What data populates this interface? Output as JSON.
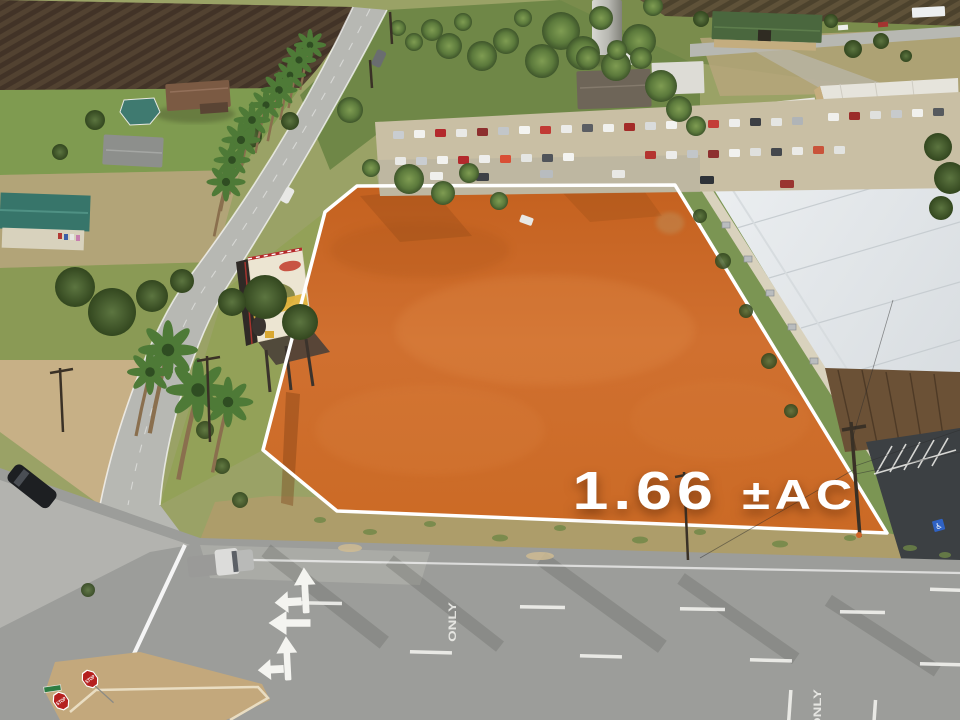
{
  "listing": {
    "acreage_value": "1.66",
    "acreage_unit": "±AC",
    "acreage_label": "1.66 ±AC",
    "parcel_fill_color": "#CE6C27",
    "parcel_outline_color": "#FFFFFF",
    "label_text_color": "#FFFFFF"
  },
  "road_markings": {
    "only_label": "ONLY",
    "stop_sign_label": "STOP"
  },
  "symbols": {
    "handicap_parking": "♿"
  }
}
